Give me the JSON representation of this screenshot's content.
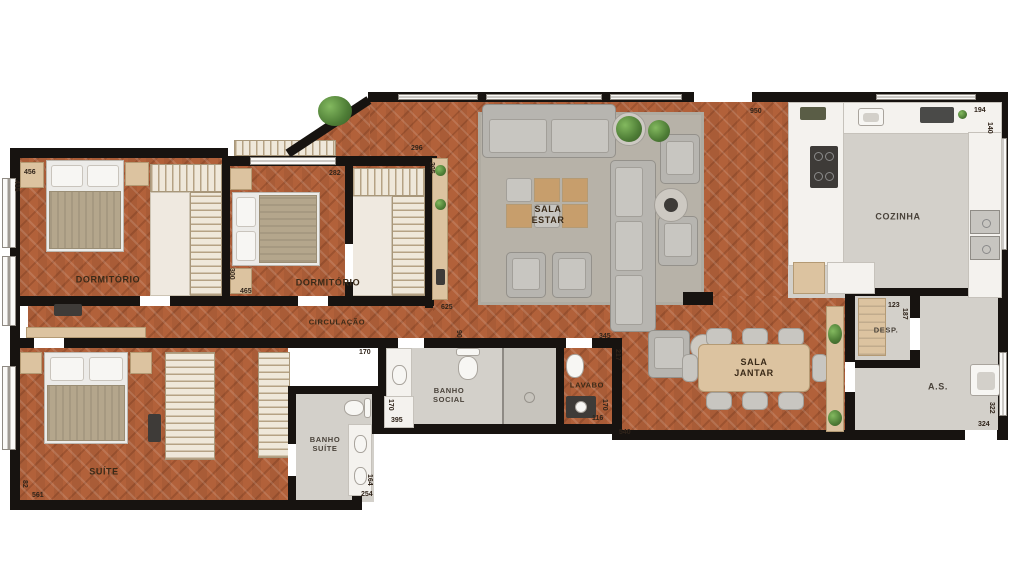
{
  "rooms": {
    "dormitorio1": "DORMITÓRIO",
    "dormitorio2": "DORMITÓRIO",
    "circulacao": "CIRCULAÇÃO",
    "sala_estar": [
      "SALA",
      "ESTAR"
    ],
    "cozinha": "COZINHA",
    "despensa": "DESP.",
    "area_servico": "A.S.",
    "sala_jantar": [
      "SALA",
      "JANTAR"
    ],
    "lavabo": "LAVABO",
    "banho_social": [
      "BANHO",
      "SOCIAL"
    ],
    "banho_suite": [
      "BANHO",
      "SUÍTE"
    ],
    "suite": "SUÍTE"
  },
  "dims": {
    "d456": "456",
    "d415": "415",
    "d296": "296",
    "d205": "205",
    "d282": "282",
    "d300": "300",
    "d465": "465",
    "d625": "625",
    "d90": "90",
    "d170_door": "170",
    "d950": "950",
    "d194": "194",
    "d140": "140",
    "d123": "123",
    "d187": "187",
    "d322": "322",
    "d324": "324",
    "d345": "345",
    "d217": "217",
    "d170_lavabo": "170",
    "d116": "116",
    "d540": "540",
    "d170_banho": "170",
    "d395": "395",
    "d164": "164",
    "d254": "254",
    "d561": "561",
    "d82": "82"
  },
  "colors": {
    "wood_floor": "#b2613a",
    "walls": "#171310",
    "tile_floor": "#d3d0ca",
    "rug": "#b7b2a8",
    "furniture_beige": "#dcc3a0",
    "fixture_white": "#f4f2ee",
    "plant_green": "#4e7d36",
    "label_text": "#3a2a18"
  }
}
